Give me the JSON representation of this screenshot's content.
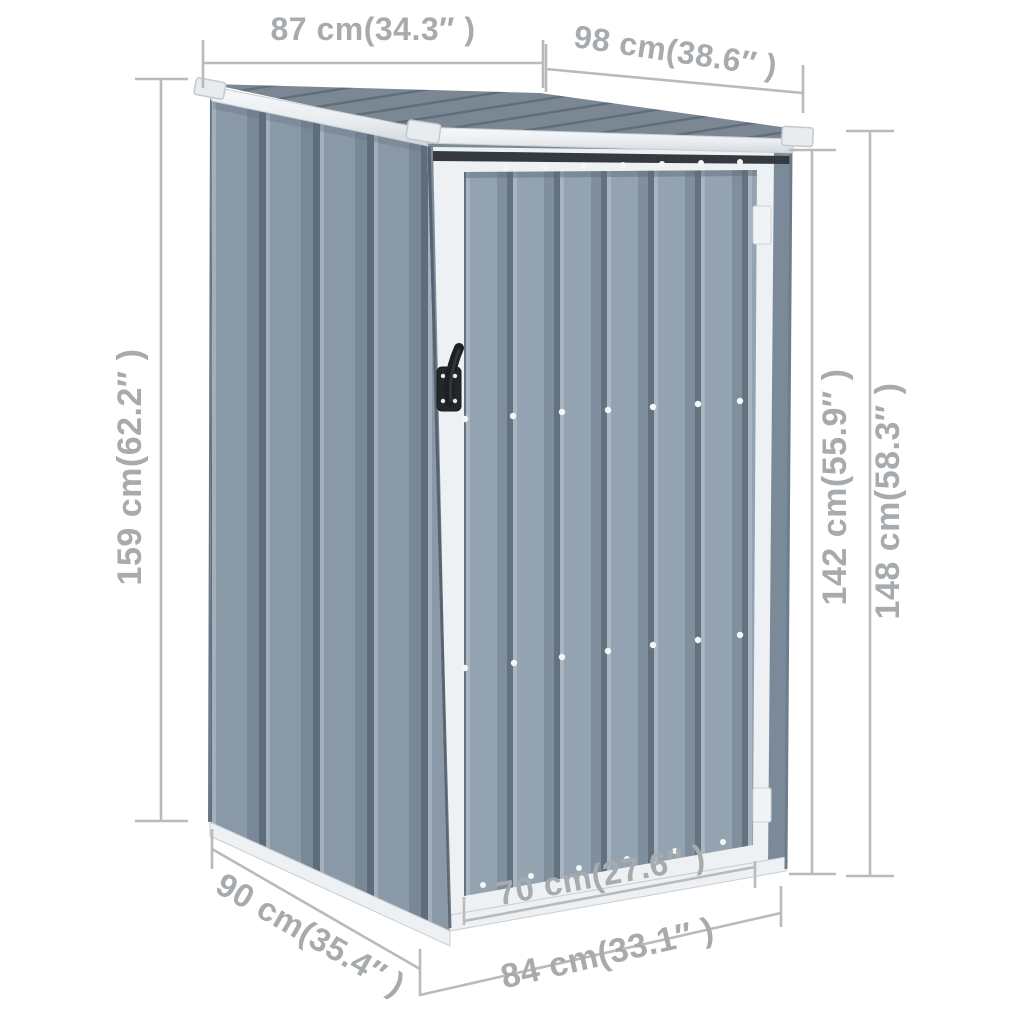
{
  "page": {
    "background": "#ffffff",
    "description": "Product dimension diagram of a gray corrugated-steel garden tool shed with pent roof and single hinged door, three-quarter view with measurement lines"
  },
  "shed": {
    "colors": {
      "wall_light": "#91a1af",
      "wall_mid": "#7e8e9c",
      "wall_shadow": "#62717e",
      "roof_base": "#7b8894",
      "roof_groove": "#606e7a",
      "trim_white": "#eef1f3",
      "handle_black": "#24272a",
      "dimension_line": "#b8babc",
      "dimension_text": "#a8abad"
    }
  },
  "dims": {
    "roof_depth_top_left": {
      "label": "87 cm(34.3″ )",
      "cm": 87,
      "inch": 34.3
    },
    "roof_width_top_right": {
      "label": "98 cm(38.6″ )",
      "cm": 98,
      "inch": 38.6
    },
    "height_left": {
      "label": "159 cm(62.2″ )",
      "cm": 159,
      "inch": 62.2
    },
    "height_door_side": {
      "label": "142 cm(55.9″ )",
      "cm": 142,
      "inch": 55.9
    },
    "height_right": {
      "label": "148 cm(58.3″ )",
      "cm": 148,
      "inch": 58.3
    },
    "base_depth_bottom_left": {
      "label": "90 cm(35.4″ )",
      "cm": 90,
      "inch": 35.4
    },
    "door_width": {
      "label": "70 cm(27.6″ )",
      "cm": 70,
      "inch": 27.6
    },
    "base_width_bottom": {
      "label": "84 cm(33.1″ )",
      "cm": 84,
      "inch": 33.1
    }
  }
}
